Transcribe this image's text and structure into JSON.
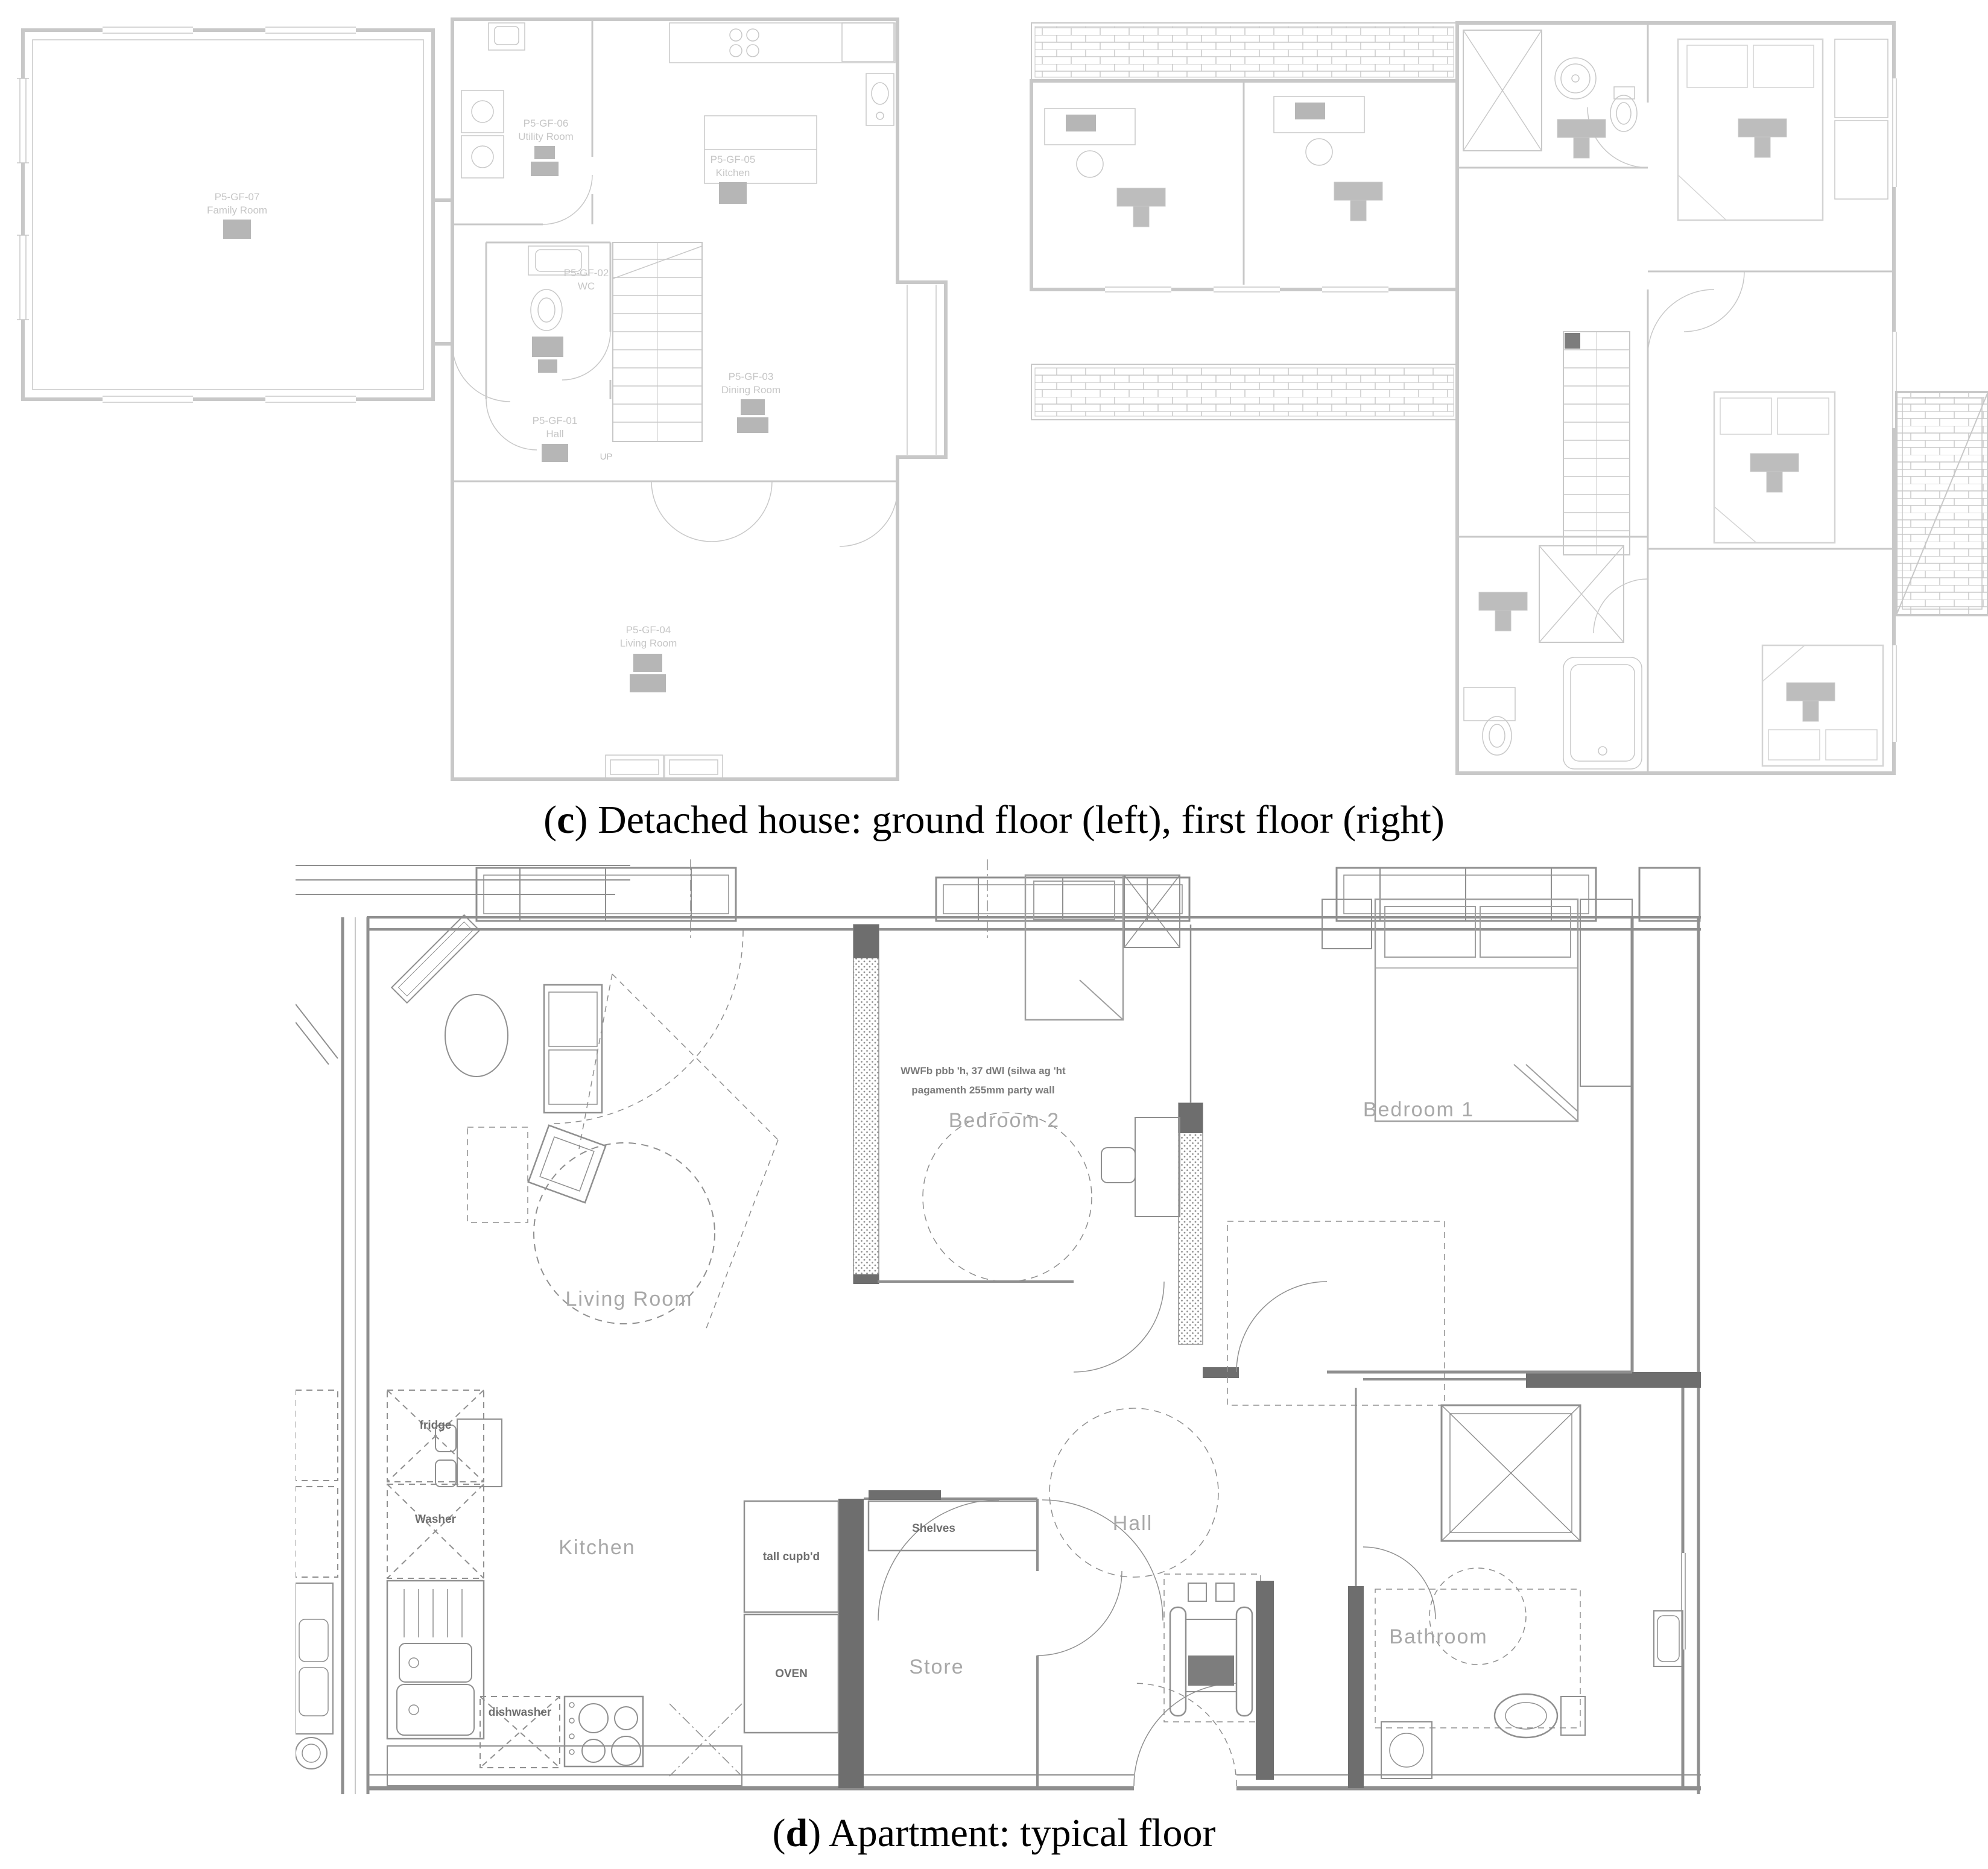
{
  "figure": {
    "panel_c": {
      "caption": {
        "open": "(",
        "letter": "c",
        "close": ") ",
        "text": "Detached house: ground floor (left), first floor (right)"
      },
      "ground_floor": {
        "rooms": [
          {
            "id": "P5-GF-07",
            "name": "Family Room"
          },
          {
            "id": "P5-GF-06",
            "name": "Utility Room"
          },
          {
            "id": "P5-GF-05",
            "name": "Kitchen"
          },
          {
            "id": "P5-GF-02",
            "name": "WC"
          },
          {
            "id": "P5-GF-03",
            "name": "Dining Room"
          },
          {
            "id": "P5-GF-01",
            "name": "Hall"
          },
          {
            "id": "P5-GF-04",
            "name": "Living Room"
          }
        ],
        "stair_label": "UP"
      }
    },
    "panel_d": {
      "caption": {
        "open": "(",
        "letter": "d",
        "close": ") ",
        "text": "Apartment: typical floor"
      },
      "apartment": {
        "room_labels": {
          "living_room": "Living Room",
          "kitchen": "Kitchen",
          "bedroom2": "Bedroom 2",
          "bedroom1": "Bedroom 1",
          "hall": "Hall",
          "store": "Store",
          "bathroom": "Bathroom"
        },
        "fitting_labels": {
          "tall_cupboard": "tall cupb'd",
          "oven": "OVEN",
          "shelves": "Shelves",
          "dishwasher": "dishwasher",
          "fridge": "fridge",
          "washer": "Washer"
        },
        "party_wall_note": {
          "line1": "WWFb pbb 'h, 37 dWl (silwa ag 'ht",
          "line2": "pagamenth 255mm party wall"
        }
      }
    },
    "colors": {
      "plan_c_line": "#c8c8c8",
      "plan_c_icon": "#b6b6b6",
      "plan_d_line": "#8f8f8f",
      "plan_d_dark": "#6e6e6e",
      "plan_d_room_text": "#a8a8a8",
      "caption_text": "#000000"
    }
  }
}
